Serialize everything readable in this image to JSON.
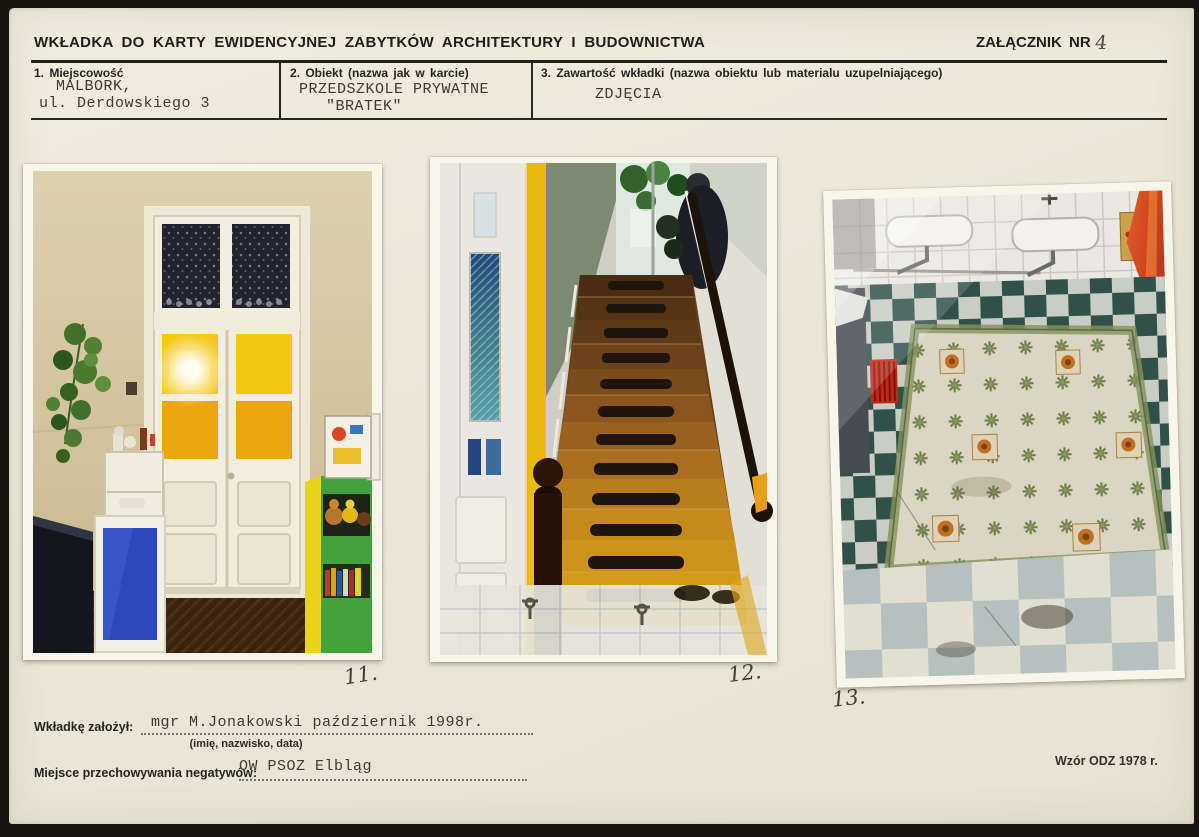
{
  "document": {
    "title": "WKŁADKA DO KARTY EWIDENCYJNEJ ZABYTKÓW ARCHITEKTURY I BUDOWNICTWA",
    "attachment": {
      "label": "ZAŁĄCZNIK NR",
      "number": "4"
    },
    "fields": [
      {
        "label": "1. Miejscowość",
        "value_lines": [
          "MALBORK,",
          "ul. Derdowskiego 3"
        ]
      },
      {
        "label": "2. Obiekt (nazwa jak w karcie)",
        "value_lines": [
          "PRZEDSZKOLE PRYWATNE",
          "\"BRATEK\""
        ]
      },
      {
        "label": "3. Zawartość wkładki (nazwa obiektu lub materialu uzupelniającego)",
        "value_lines": [
          "ZDJĘCIA"
        ]
      }
    ],
    "photos": [
      {
        "label": "11."
      },
      {
        "label": "12."
      },
      {
        "label": "13."
      }
    ],
    "footer": {
      "founder_label": "Wkładkę założył:",
      "founder_value": "mgr M.Jonakowski  październik 1998r.",
      "founder_hint": "(imię, nazwisko, data)",
      "negatives_label": "Miejsce przechowywania negatywów:",
      "negatives_value": "OW PSOZ Elbląg",
      "form_note": "Wzór ODZ 1978 r."
    },
    "colors": {
      "paper": "#ece8db",
      "ink": "#211f1a",
      "typewriter": "#3e3a32",
      "pencil": "#4d4a43",
      "scan_background": "#17140f"
    }
  }
}
